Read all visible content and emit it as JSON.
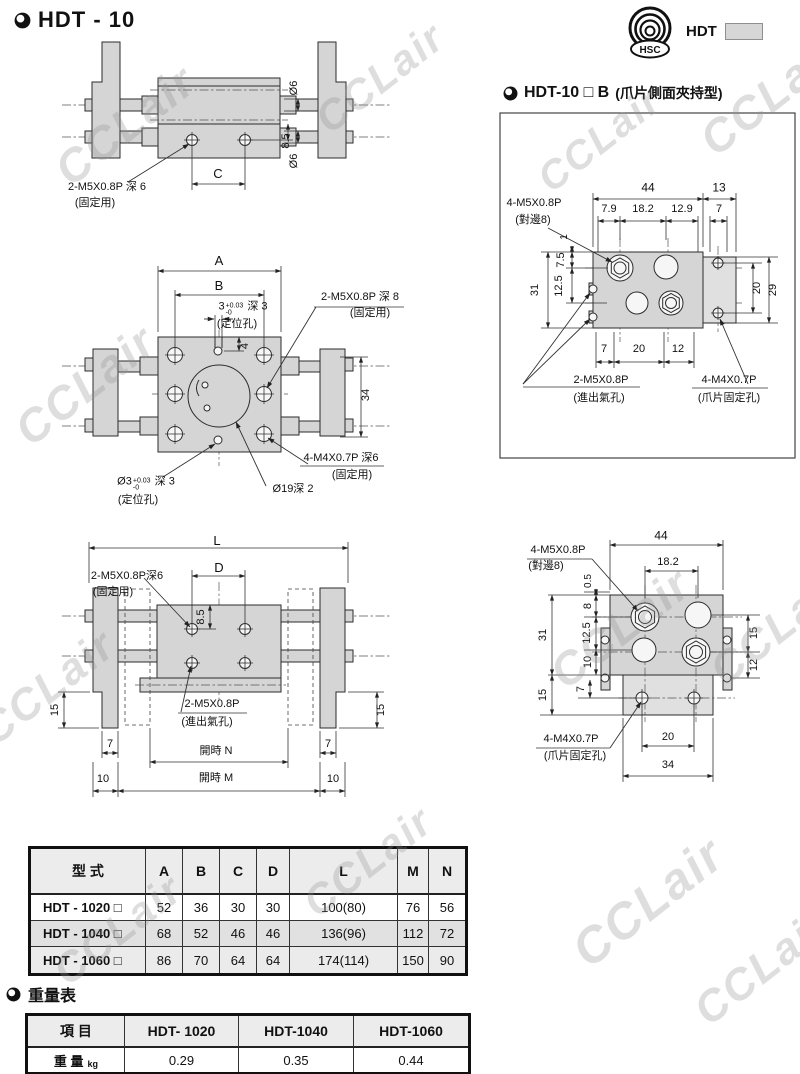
{
  "header": {
    "title": "HDT - 10"
  },
  "logo": {
    "label": "HDT",
    "badge": "HSC"
  },
  "section_b": {
    "model": "HDT-10 □ B",
    "note": "(爪片側面夾持型)"
  },
  "weight_section": {
    "title": "重量表"
  },
  "watermark": {
    "text": "CCLair",
    "color": "#c8c8c8"
  },
  "colors": {
    "body_fill": "#d5d5d5",
    "line": "#2b2b2b",
    "table_header_bg": "#ececec"
  },
  "spec_table": {
    "headers": [
      "型 式",
      "A",
      "B",
      "C",
      "D",
      "L",
      "M",
      "N"
    ],
    "rows": [
      {
        "model": "HDT - 1020 □",
        "bg": "#ffffff",
        "values": [
          "52",
          "36",
          "30",
          "30",
          "100(80)",
          "76",
          "56"
        ]
      },
      {
        "model": "HDT - 1040 □",
        "bg": "#e1e1e1",
        "values": [
          "68",
          "52",
          "46",
          "46",
          "136(96)",
          "112",
          "72"
        ]
      },
      {
        "model": "HDT - 1060 □",
        "bg": "#ebebeb",
        "values": [
          "86",
          "70",
          "64",
          "64",
          "174(114)",
          "150",
          "90"
        ]
      }
    ]
  },
  "weight_table": {
    "headers": [
      "項 目",
      "HDT- 1020",
      "HDT-1040",
      "HDT-1060"
    ],
    "row_label": "重 量",
    "row_unit": "kg",
    "values": [
      "0.29",
      "0.35",
      "0.44"
    ]
  },
  "watermarks": [
    {
      "x": 125,
      "y": 125,
      "s": 46
    },
    {
      "x": 380,
      "y": 78,
      "s": 42
    },
    {
      "x": 770,
      "y": 95,
      "s": 46
    },
    {
      "x": 85,
      "y": 385,
      "s": 46
    },
    {
      "x": 600,
      "y": 140,
      "s": 40
    },
    {
      "x": 620,
      "y": 628,
      "s": 46
    },
    {
      "x": 778,
      "y": 628,
      "s": 44
    },
    {
      "x": 48,
      "y": 688,
      "s": 44
    },
    {
      "x": 368,
      "y": 862,
      "s": 42
    },
    {
      "x": 118,
      "y": 930,
      "s": 42
    },
    {
      "x": 648,
      "y": 902,
      "s": 50
    },
    {
      "x": 762,
      "y": 968,
      "s": 44
    }
  ],
  "dim_labels": [
    {
      "t": "Ø6",
      "x": 295,
      "y": 88,
      "r": -90
    },
    {
      "t": "8.5",
      "x": 287,
      "y": 141,
      "r": -90
    },
    {
      "t": "Ø6",
      "x": 295,
      "y": 161,
      "r": -90
    },
    {
      "t": "C",
      "x": 218,
      "y": 174,
      "fs": 13
    },
    {
      "t": "2-M5X0.8P 深 6",
      "x": 107,
      "y": 188
    },
    {
      "t": "(固定用)",
      "x": 95,
      "y": 204
    },
    {
      "t": "A",
      "x": 219,
      "y": 261,
      "fs": 13
    },
    {
      "t": "B",
      "x": 219,
      "y": 286,
      "fs": 13
    },
    {
      "t": "3",
      "sup": "+0.03",
      "sub": "-0",
      "tail": " 深 3",
      "x": 243,
      "y": 309
    },
    {
      "t": "(定位孔)",
      "x": 237,
      "y": 325
    },
    {
      "t": "2-M5X0.8P 深 8",
      "x": 360,
      "y": 298
    },
    {
      "t": "(固定用)",
      "x": 370,
      "y": 314
    },
    {
      "t": "4",
      "x": 246,
      "y": 346,
      "r": -90
    },
    {
      "t": "34",
      "x": 367,
      "y": 395,
      "r": -90
    },
    {
      "t": "Ø3",
      "sup": "+0.03",
      "sub": "-0",
      "tail": " 深 3",
      "x": 146,
      "y": 484
    },
    {
      "t": "(定位孔)",
      "x": 138,
      "y": 501
    },
    {
      "t": "Ø19深 2",
      "x": 293,
      "y": 490
    },
    {
      "t": "4-M4X0.7P 深6",
      "x": 341,
      "y": 459
    },
    {
      "t": "(固定用)",
      "x": 352,
      "y": 476
    },
    {
      "t": "L",
      "x": 217,
      "y": 541,
      "fs": 13
    },
    {
      "t": "D",
      "x": 219,
      "y": 568,
      "fs": 13
    },
    {
      "t": "2-M5X0.8P深6",
      "x": 127,
      "y": 577
    },
    {
      "t": "(固定用)",
      "x": 113,
      "y": 593
    },
    {
      "t": "8.5",
      "x": 202,
      "y": 617,
      "r": -90
    },
    {
      "t": "15",
      "x": 56,
      "y": 710,
      "r": -90
    },
    {
      "t": "15",
      "x": 382,
      "y": 710,
      "r": -90
    },
    {
      "t": "7",
      "x": 110,
      "y": 745
    },
    {
      "t": "7",
      "x": 328,
      "y": 745
    },
    {
      "t": "開時 N",
      "x": 216,
      "y": 752
    },
    {
      "t": "10",
      "x": 103,
      "y": 780
    },
    {
      "t": "10",
      "x": 333,
      "y": 780
    },
    {
      "t": "開時 M",
      "x": 216,
      "y": 779
    },
    {
      "t": "2-M5X0.8P",
      "x": 212,
      "y": 705
    },
    {
      "t": "(進出氣孔)",
      "x": 207,
      "y": 723
    },
    {
      "t": "44",
      "x": 661,
      "y": 536,
      "fs": 12
    },
    {
      "t": "18.2",
      "x": 668,
      "y": 563
    },
    {
      "t": "4-M5X0.8P",
      "x": 558,
      "y": 551
    },
    {
      "t": "(對邊8)",
      "x": 546,
      "y": 567
    },
    {
      "t": "0.5",
      "x": 589,
      "y": 581,
      "r": -90,
      "fs": 10
    },
    {
      "t": "8",
      "x": 589,
      "y": 606,
      "r": -90
    },
    {
      "t": "12.5",
      "x": 588,
      "y": 633,
      "r": -90
    },
    {
      "t": "10",
      "x": 589,
      "y": 662,
      "r": -90
    },
    {
      "t": "31",
      "x": 544,
      "y": 635,
      "r": -90
    },
    {
      "t": "15",
      "x": 544,
      "y": 695,
      "r": -90
    },
    {
      "t": "7",
      "x": 582,
      "y": 689,
      "r": -90
    },
    {
      "t": "15",
      "x": 755,
      "y": 633,
      "r": -90
    },
    {
      "t": "12",
      "x": 755,
      "y": 665,
      "r": -90
    },
    {
      "t": "20",
      "x": 668,
      "y": 738
    },
    {
      "t": "34",
      "x": 668,
      "y": 766
    },
    {
      "t": "4-M4X0.7P",
      "x": 571,
      "y": 740
    },
    {
      "t": "(爪片固定孔)",
      "x": 575,
      "y": 757
    },
    {
      "t": "44",
      "x": 648,
      "y": 188,
      "fs": 12
    },
    {
      "t": "13",
      "x": 719,
      "y": 188,
      "fs": 12
    },
    {
      "t": "7.9",
      "x": 609,
      "y": 210
    },
    {
      "t": "18.2",
      "x": 643,
      "y": 210
    },
    {
      "t": "12.9",
      "x": 682,
      "y": 210
    },
    {
      "t": "7",
      "x": 719,
      "y": 210
    },
    {
      "t": "4-M5X0.8P",
      "x": 534,
      "y": 204
    },
    {
      "t": "(對邊8)",
      "x": 533,
      "y": 221
    },
    {
      "t": "1",
      "x": 565,
      "y": 237,
      "r": -90,
      "fs": 10
    },
    {
      "t": "7.5",
      "x": 562,
      "y": 260,
      "r": -90
    },
    {
      "t": "12.5",
      "x": 560,
      "y": 286,
      "r": -90
    },
    {
      "t": "31",
      "x": 536,
      "y": 290,
      "r": -90
    },
    {
      "t": "20",
      "x": 758,
      "y": 288,
      "r": -90
    },
    {
      "t": "29",
      "x": 774,
      "y": 290,
      "r": -90
    },
    {
      "t": "7",
      "x": 604,
      "y": 350
    },
    {
      "t": "20",
      "x": 639,
      "y": 350
    },
    {
      "t": "12",
      "x": 678,
      "y": 350
    },
    {
      "t": "2-M5X0.8P",
      "x": 601,
      "y": 381
    },
    {
      "t": "(進出氣孔)",
      "x": 599,
      "y": 399
    },
    {
      "t": "4-M4X0.7P",
      "x": 729,
      "y": 381
    },
    {
      "t": "(爪片固定孔)",
      "x": 729,
      "y": 399
    }
  ]
}
